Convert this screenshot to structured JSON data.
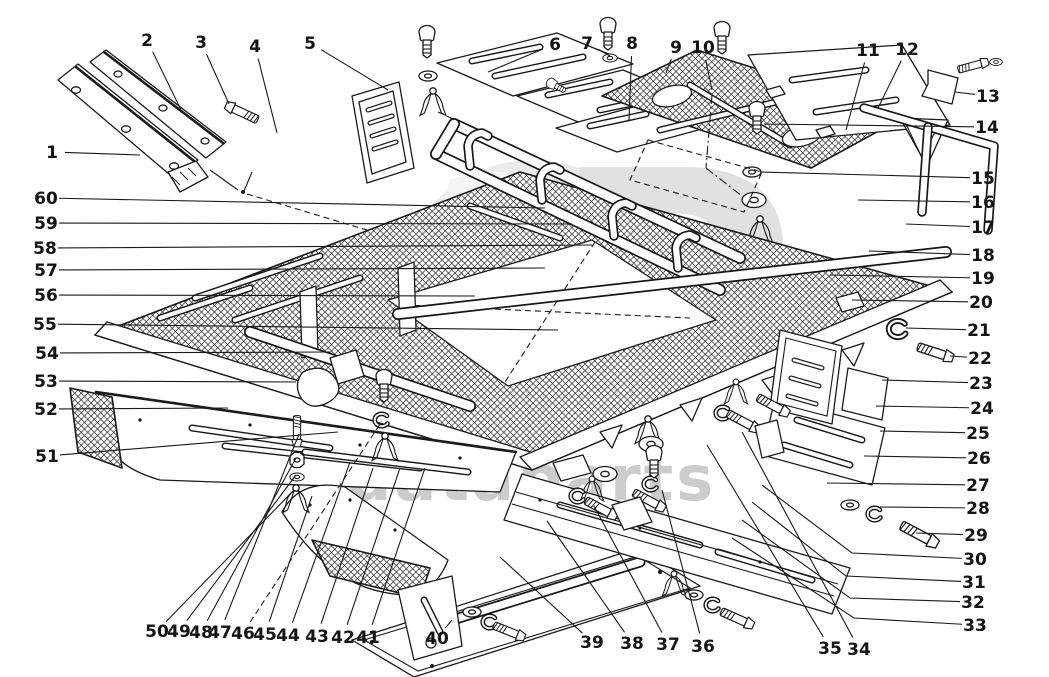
{
  "watermark": {
    "word_left": "data",
    "word_right": "parts",
    "monogram": "P"
  },
  "callouts": [
    {
      "n": "1",
      "x": 52,
      "y": 152,
      "tx": 140,
      "ty": 155
    },
    {
      "n": "2",
      "x": 147,
      "y": 40,
      "tx": 182,
      "ty": 112
    },
    {
      "n": "3",
      "x": 201,
      "y": 42,
      "tx": 229,
      "ty": 104
    },
    {
      "n": "4",
      "x": 255,
      "y": 46,
      "tx": 277,
      "ty": 133
    },
    {
      "n": "5",
      "x": 310,
      "y": 43,
      "tx": 388,
      "ty": 90
    },
    {
      "n": "6",
      "x": 555,
      "y": 44,
      "tx": 488,
      "ty": 72
    },
    {
      "n": "7",
      "x": 587,
      "y": 43,
      "tx": 610,
      "ty": 56
    },
    {
      "n": "8",
      "x": 632,
      "y": 43,
      "tx": 629,
      "ty": 120
    },
    {
      "n": "9",
      "x": 676,
      "y": 47,
      "tx": 666,
      "ty": 73
    },
    {
      "n": "10",
      "x": 703,
      "y": 47,
      "tx": 712,
      "ty": 90
    },
    {
      "n": "11",
      "x": 868,
      "y": 50,
      "tx": 846,
      "ty": 130
    },
    {
      "n": "12",
      "x": 907,
      "y": 49,
      "tx": 878,
      "ty": 108
    },
    {
      "n": "13",
      "x": 988,
      "y": 96,
      "tx": 955,
      "ty": 92
    },
    {
      "n": "14",
      "x": 987,
      "y": 127,
      "tx": 764,
      "ty": 124
    },
    {
      "n": "15",
      "x": 983,
      "y": 178,
      "tx": 760,
      "ty": 172
    },
    {
      "n": "16",
      "x": 983,
      "y": 202,
      "tx": 858,
      "ty": 200
    },
    {
      "n": "17",
      "x": 983,
      "y": 227,
      "tx": 906,
      "ty": 224
    },
    {
      "n": "18",
      "x": 983,
      "y": 255,
      "tx": 869,
      "ty": 251
    },
    {
      "n": "19",
      "x": 983,
      "y": 278,
      "tx": 830,
      "ty": 275
    },
    {
      "n": "20",
      "x": 981,
      "y": 302,
      "tx": 852,
      "ty": 300
    },
    {
      "n": "21",
      "x": 979,
      "y": 330,
      "tx": 906,
      "ty": 328
    },
    {
      "n": "22",
      "x": 980,
      "y": 358,
      "tx": 950,
      "ty": 356
    },
    {
      "n": "23",
      "x": 981,
      "y": 383,
      "tx": 882,
      "ty": 380
    },
    {
      "n": "24",
      "x": 982,
      "y": 408,
      "tx": 876,
      "ty": 406
    },
    {
      "n": "25",
      "x": 978,
      "y": 433,
      "tx": 880,
      "ty": 431
    },
    {
      "n": "26",
      "x": 979,
      "y": 458,
      "tx": 864,
      "ty": 456
    },
    {
      "n": "27",
      "x": 978,
      "y": 485,
      "tx": 827,
      "ty": 483
    },
    {
      "n": "28",
      "x": 978,
      "y": 508,
      "tx": 880,
      "ty": 507
    },
    {
      "n": "29",
      "x": 976,
      "y": 535,
      "tx": 916,
      "ty": 533
    },
    {
      "n": "30",
      "x": 975,
      "y": 559,
      "bx": 852,
      "by": 553,
      "tx": 762,
      "ty": 485
    },
    {
      "n": "31",
      "x": 974,
      "y": 582,
      "bx": 846,
      "by": 576,
      "tx": 752,
      "ty": 502
    },
    {
      "n": "32",
      "x": 973,
      "y": 602,
      "bx": 850,
      "by": 598,
      "tx": 742,
      "ty": 520
    },
    {
      "n": "33",
      "x": 975,
      "y": 625,
      "bx": 854,
      "by": 618,
      "tx": 732,
      "ty": 538
    },
    {
      "n": "34",
      "x": 859,
      "y": 649,
      "tx": 742,
      "ty": 432
    },
    {
      "n": "35",
      "x": 830,
      "y": 648,
      "tx": 707,
      "ty": 445
    },
    {
      "n": "36",
      "x": 703,
      "y": 646,
      "tx": 662,
      "ty": 490
    },
    {
      "n": "37",
      "x": 668,
      "y": 644,
      "tx": 594,
      "ty": 506
    },
    {
      "n": "38",
      "x": 632,
      "y": 643,
      "tx": 547,
      "ty": 521
    },
    {
      "n": "39",
      "x": 592,
      "y": 642,
      "tx": 500,
      "ty": 557
    },
    {
      "n": "40",
      "x": 437,
      "y": 638,
      "tx": 452,
      "ty": 620
    },
    {
      "n": "41",
      "x": 368,
      "y": 637,
      "tx": 425,
      "ty": 468
    },
    {
      "n": "42",
      "x": 343,
      "y": 637,
      "tx": 400,
      "ty": 468
    },
    {
      "n": "43",
      "x": 317,
      "y": 636,
      "tx": 373,
      "ty": 468
    },
    {
      "n": "44",
      "x": 288,
      "y": 635,
      "tx": 350,
      "ty": 462
    },
    {
      "n": "45",
      "x": 265,
      "y": 634,
      "tx": 312,
      "ty": 496
    },
    {
      "n": "46",
      "x": 243,
      "y": 633,
      "tx": 382,
      "ty": 421,
      "dash": true
    },
    {
      "n": "47",
      "x": 220,
      "y": 632,
      "tx": 299,
      "ty": 434
    },
    {
      "n": "48",
      "x": 201,
      "y": 632,
      "tx": 296,
      "ty": 458
    },
    {
      "n": "49",
      "x": 179,
      "y": 631,
      "tx": 296,
      "ty": 475
    },
    {
      "n": "50",
      "x": 157,
      "y": 631,
      "tx": 294,
      "ty": 490
    },
    {
      "n": "51",
      "x": 47,
      "y": 456,
      "tx": 338,
      "ty": 432
    },
    {
      "n": "52",
      "x": 46,
      "y": 409,
      "tx": 228,
      "ty": 408
    },
    {
      "n": "53",
      "x": 46,
      "y": 381,
      "tx": 296,
      "ty": 382
    },
    {
      "n": "54",
      "x": 47,
      "y": 353,
      "tx": 330,
      "ty": 352
    },
    {
      "n": "55",
      "x": 45,
      "y": 324,
      "tx": 558,
      "ty": 330
    },
    {
      "n": "56",
      "x": 46,
      "y": 295,
      "tx": 475,
      "ty": 296
    },
    {
      "n": "57",
      "x": 46,
      "y": 270,
      "tx": 545,
      "ty": 268
    },
    {
      "n": "58",
      "x": 45,
      "y": 248,
      "tx": 592,
      "ty": 245
    },
    {
      "n": "59",
      "x": 46,
      "y": 223,
      "tx": 572,
      "ty": 224
    },
    {
      "n": "60",
      "x": 46,
      "y": 198,
      "tx": 545,
      "ty": 208
    }
  ]
}
